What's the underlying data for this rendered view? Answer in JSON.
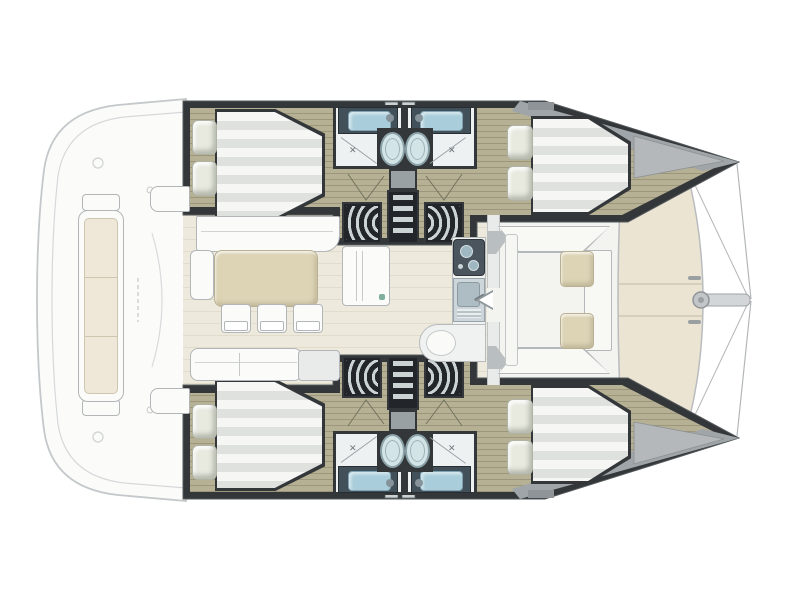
{
  "diagram": {
    "type": "catamaran-deck-plan",
    "orientation": "bow-right",
    "port_hull": {
      "aft_cabin": {
        "name": "port-aft-double-cabin",
        "berth": "double",
        "pillows": 2
      },
      "fwd_cabin": {
        "name": "port-fwd-double-cabin",
        "berth": "double",
        "pillows": 2
      },
      "heads": [
        {
          "name": "port-aft-head",
          "fixtures": [
            "sink",
            "toilet",
            "shower"
          ]
        },
        {
          "name": "port-fwd-head",
          "fixtures": [
            "sink",
            "toilet",
            "shower"
          ]
        }
      ],
      "access": "companionway-ladder-with-curved-steps"
    },
    "starboard_hull": {
      "aft_cabin": {
        "name": "starboard-aft-double-cabin",
        "berth": "double",
        "pillows": 2
      },
      "fwd_cabin": {
        "name": "starboard-fwd-double-cabin",
        "berth": "double",
        "pillows": 2
      },
      "heads": [
        {
          "name": "starboard-aft-head",
          "fixtures": [
            "sink",
            "toilet",
            "shower"
          ]
        },
        {
          "name": "starboard-fwd-head",
          "fixtures": [
            "sink",
            "toilet",
            "shower"
          ]
        }
      ],
      "access": "companionway-ladder-with-curved-steps"
    },
    "salon": {
      "features": [
        "l-shaped-sofa",
        "dining-table",
        "dining-chairs",
        "cabinet",
        "aft-sofa",
        "nav-seat"
      ],
      "dining_chairs": 3
    },
    "galley": {
      "features": [
        "two-burner-stove",
        "sink-with-faucet",
        "counter-with-round-basin"
      ]
    },
    "forward_cockpit": {
      "features": [
        "u-shaped-seating",
        "back-cushions",
        "side-bench",
        "door-to-salon"
      ],
      "back_cushions": 2
    },
    "aft_deck": {
      "features": [
        "bench-with-cushion",
        "swim-steps",
        "deck-hatches"
      ],
      "bench_cushion_sections": 3
    },
    "bow": {
      "features": [
        "sunpad",
        "front-beam",
        "bowsprit",
        "forestay-lines",
        "cleats"
      ],
      "sunpad_sections": 3
    }
  },
  "colors": {
    "wall": "#33373a",
    "wall-dark": "#22262a",
    "white-furn": "#fbfbfa",
    "furn-border": "#b2b6b8",
    "beige": "#ddd4b6",
    "beige-border": "#b9b094",
    "pillow": "#e8eae0",
    "duvet-light": "#f6f7f5",
    "duvet-dark": "#dee1de",
    "sink-counter": "#42505a",
    "sink-basin": "#a9cdda",
    "toilet": "#d3e4e7",
    "toilet-rim": "#8ba2a8",
    "bath-floor": "#eef1f1",
    "slat": "#ccd3d4",
    "sunpad": "#ebe4d3",
    "bow-deck": "#b5b8ba",
    "hull-floor": "#b6b194",
    "salon-floor": "#edeadd",
    "cockpit-floor": "#f3f3f0",
    "deck-line": "#c5c8ca",
    "cushion-cream": "#efe8d8"
  }
}
